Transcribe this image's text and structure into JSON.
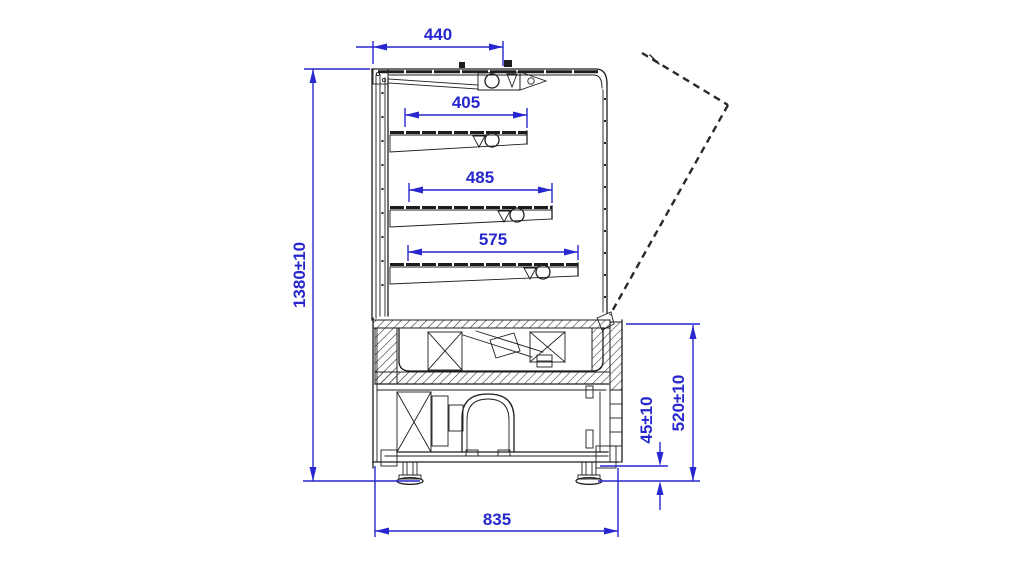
{
  "drawing": {
    "type": "technical-section-drawing",
    "subject": "refrigerated-display-case-side-section",
    "background_color": "#ffffff",
    "line_color": "#1d1d1d",
    "dimension_color": "#2727cf",
    "dims": {
      "canopy_depth": "440",
      "shelf_1_depth": "405",
      "shelf_2_depth": "485",
      "shelf_3_depth": "575",
      "overall_height": "1380±10",
      "foot_height": "45±10",
      "base_height": "520±10",
      "base_depth": "835"
    }
  }
}
